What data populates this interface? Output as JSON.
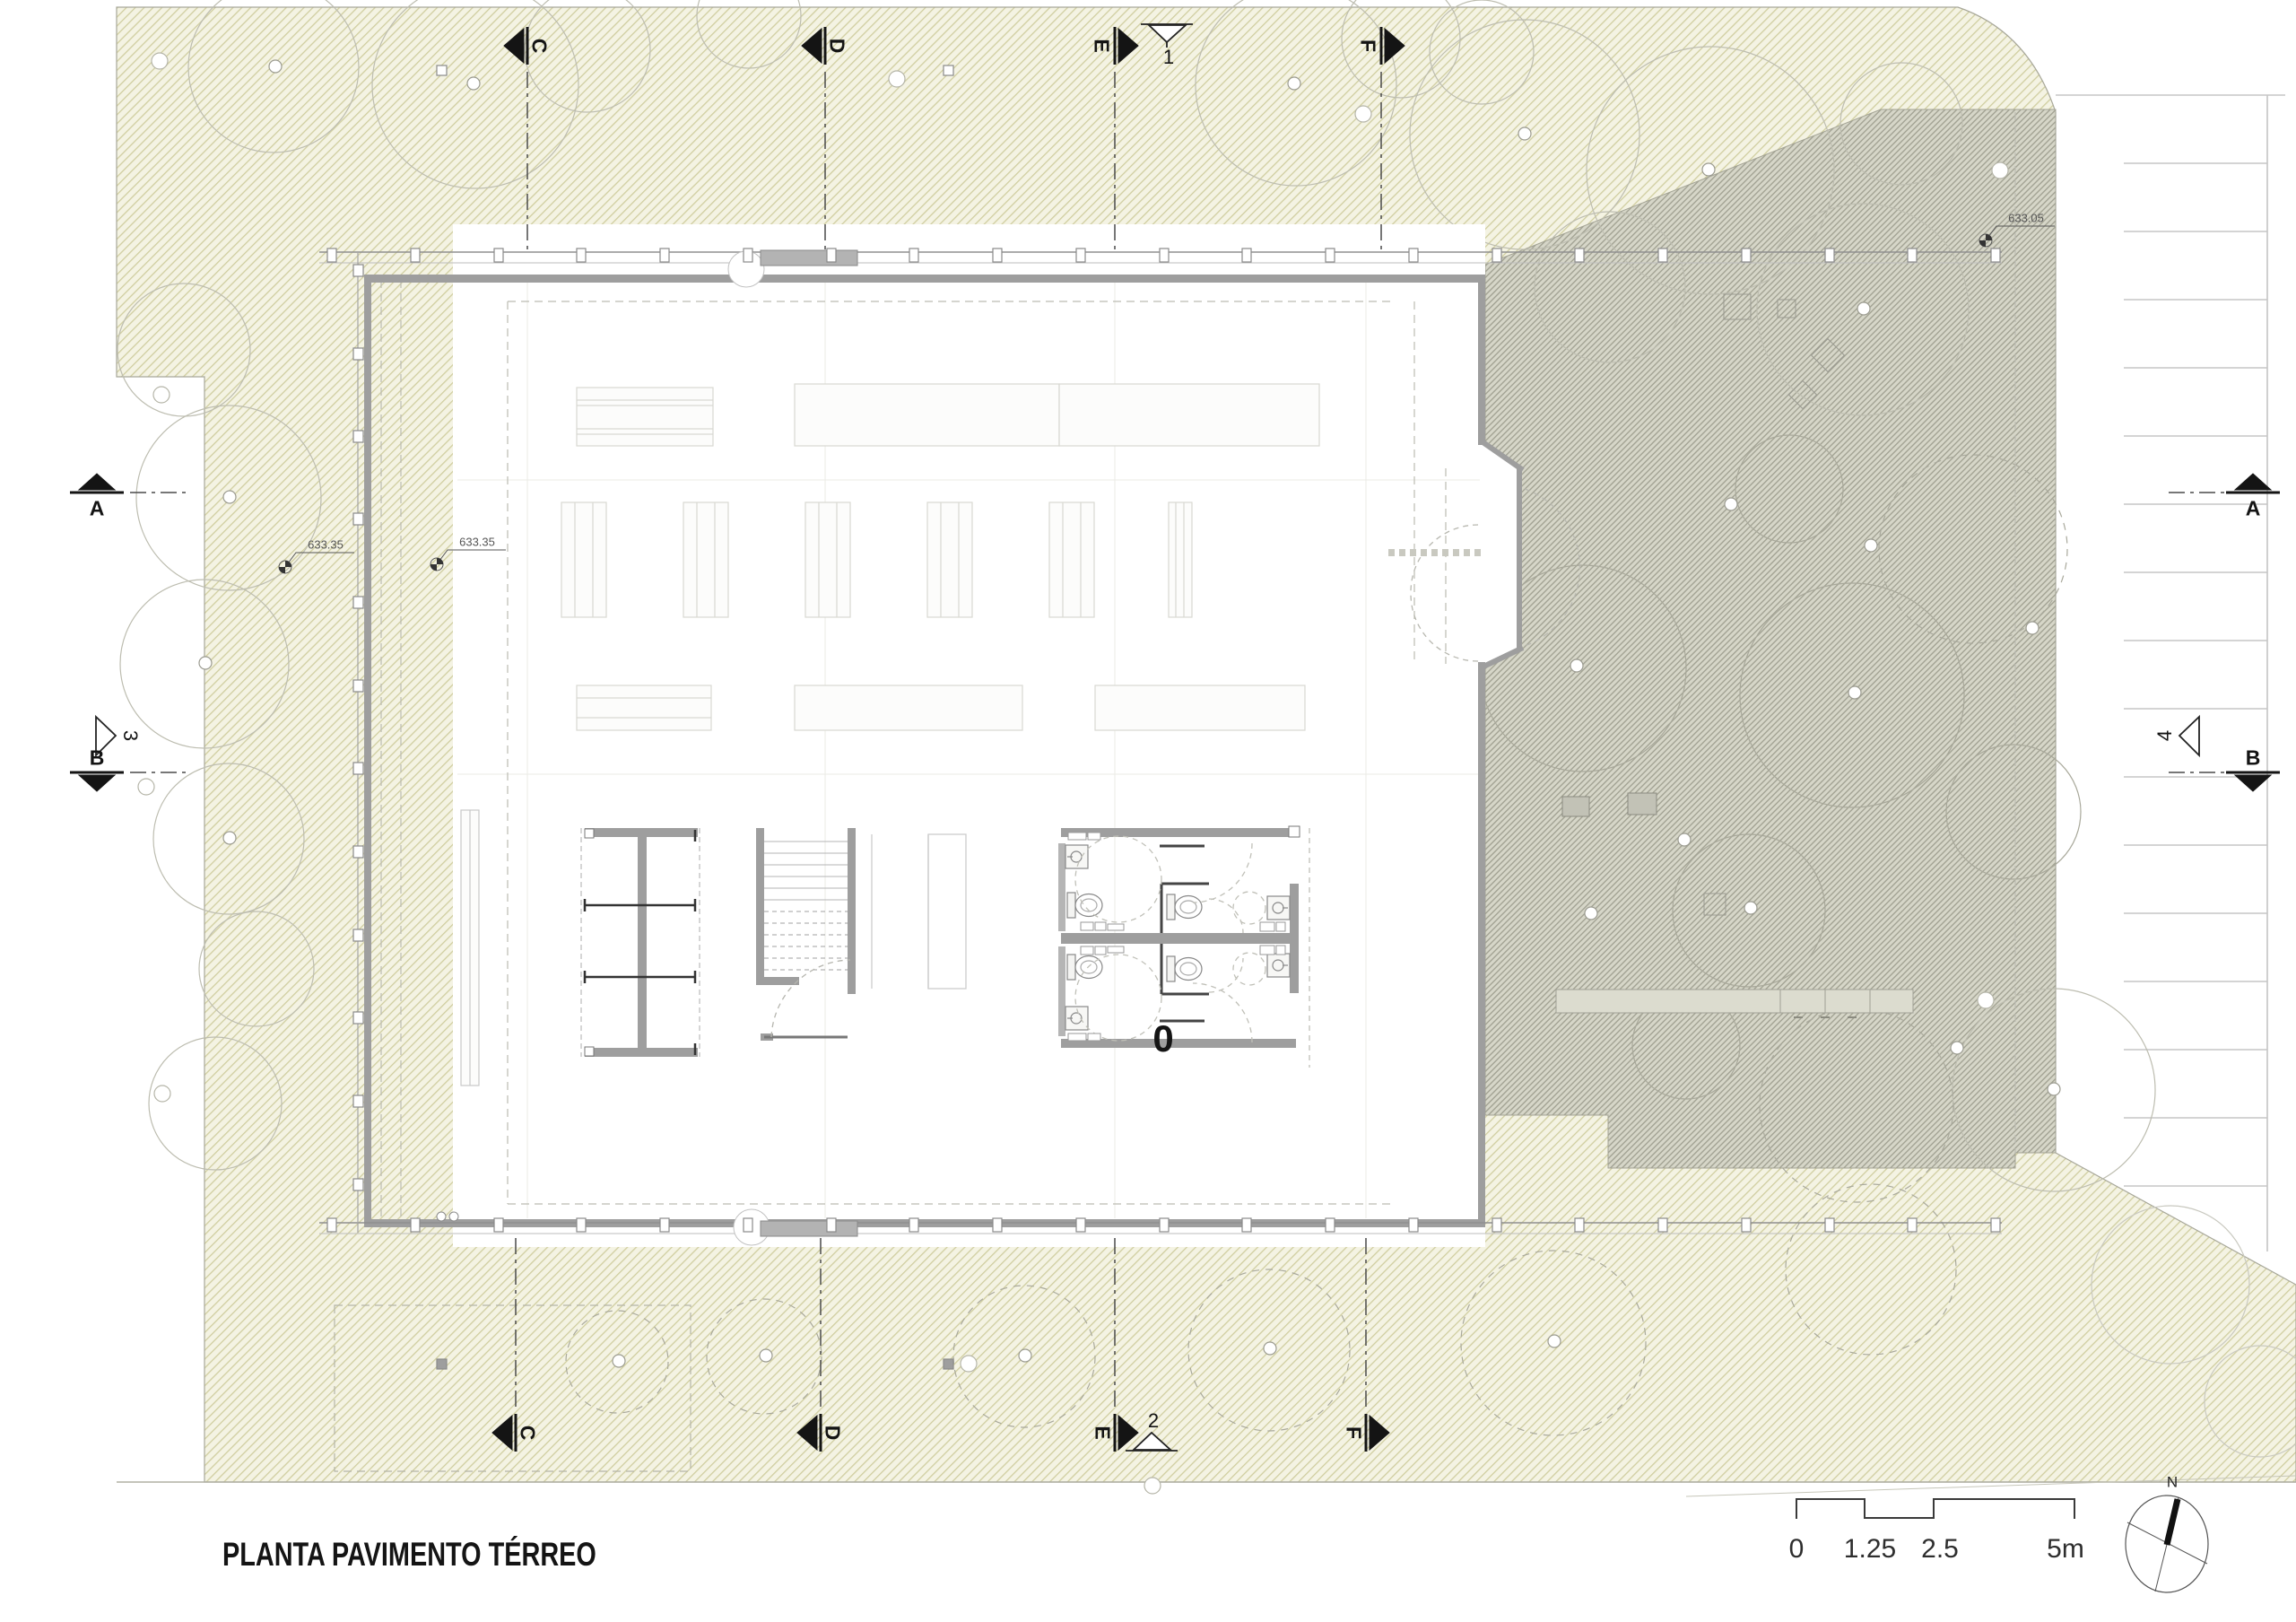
{
  "title": "PLANTA PAVIMENTO TÉRREO",
  "plan": {
    "level_label": "0"
  },
  "north": {
    "label": "N"
  },
  "scalebar": {
    "t0": "0",
    "t1": "1.25",
    "t2": "2.5",
    "t3": "5m"
  },
  "spot_elevations": {
    "sp1": "633.35",
    "sp2": "633.35",
    "sp3": "633.05"
  },
  "markers": {
    "top": [
      {
        "label": "C"
      },
      {
        "label": "D"
      },
      {
        "label": "E"
      },
      {
        "label": "F"
      }
    ],
    "bottom": [
      {
        "label": "C"
      },
      {
        "label": "D"
      },
      {
        "label": "E"
      },
      {
        "label": "F"
      }
    ],
    "left": [
      {
        "label": "A"
      },
      {
        "label": "B"
      }
    ],
    "right": [
      {
        "label": "A"
      },
      {
        "label": "B"
      }
    ],
    "views": {
      "v1": "1",
      "v2": "2",
      "v3": "3",
      "v4": "4"
    }
  },
  "colors": {
    "site_hatch_base": "#f4f3e3",
    "site_hatch_line": "#d0cea0",
    "deck_hatch_base": "#d7d7c9",
    "deck_hatch_line": "#a3a394",
    "wall_gray": "#9e9e9e",
    "marker_black": "#141414",
    "tree_outline": "#bdbdb0"
  }
}
